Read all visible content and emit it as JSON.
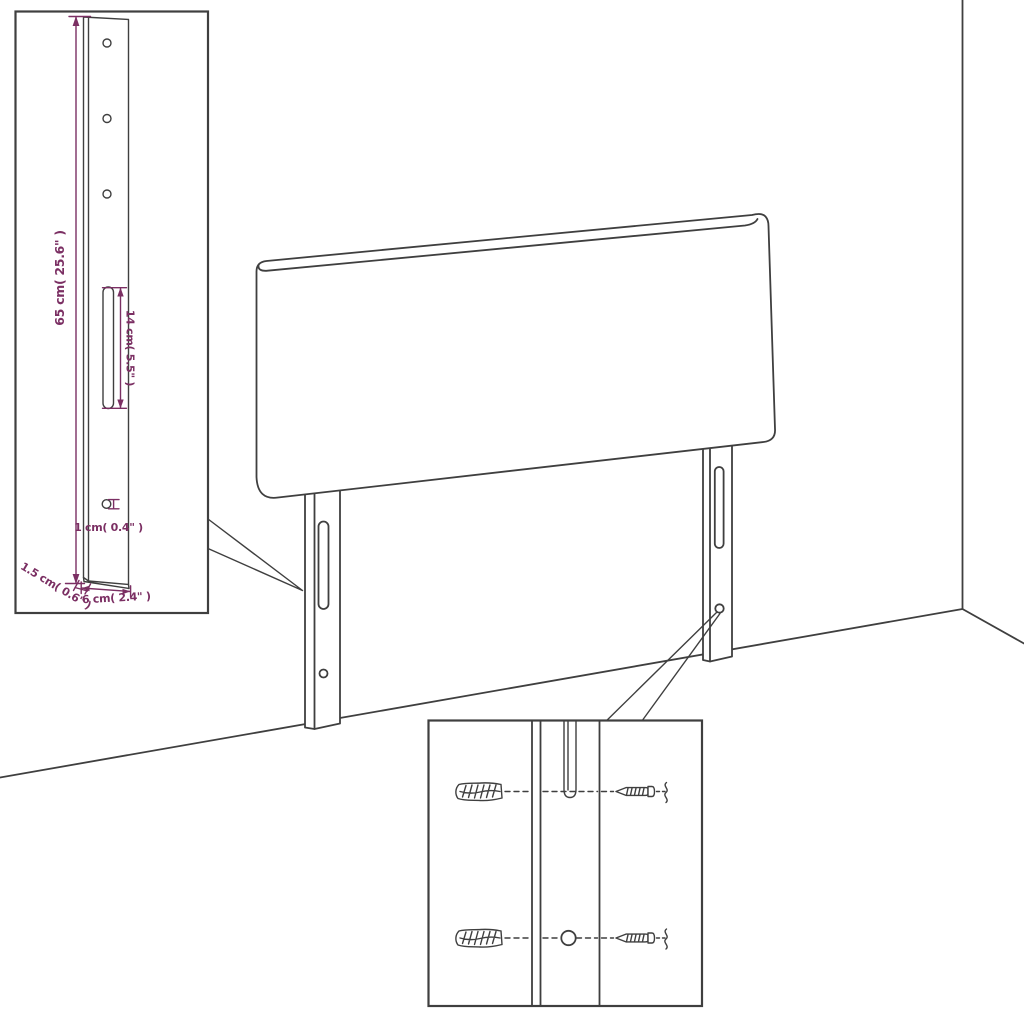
{
  "diagram": {
    "subject": "headboard assembly drawing with leg detail and wall-mounting detail",
    "colors": {
      "line": "#3f3f3f",
      "dimension": "#7b2f63",
      "background": "#ffffff"
    },
    "dimensions": {
      "leg_height": "65 cm( 25.6\" )",
      "slot_length": "14 cm( 5.5\" )",
      "hole_diameter": "1 cm( 0.4\" )",
      "board_thickness": "1.5 cm( 0.6\" )",
      "leg_width": "6 cm( 2.4\" )"
    }
  }
}
